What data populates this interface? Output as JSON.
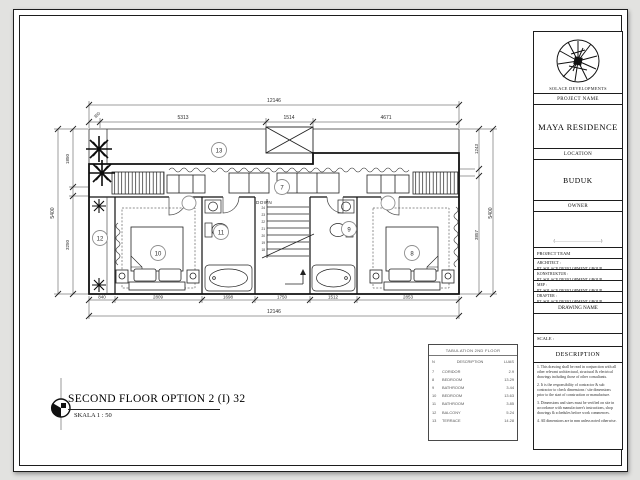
{
  "sheet_title": {
    "text": "SECOND FLOOR OPTION 2  (I) 32",
    "scale": "SKALA 1 : 50"
  },
  "title_block": {
    "company": "SOLACE DEVELOPMENTS",
    "project_name_label": "PROJECT NAME",
    "project_name": "MAYA RESIDENCE",
    "location_label": "LOCATION",
    "location": "BUDUK",
    "owner_label": "OWNER",
    "owner_value": "(..............................................)",
    "project_team_label": "PROJECT TEAM",
    "team": [
      {
        "role": "ARCHITECT :",
        "name": "PT. SOLACE DEVELOPMENT GROUP"
      },
      {
        "role": "KONSTRUKTUR :",
        "name": "PT. SOLACE DEVELOPMENT GROUP"
      },
      {
        "role": "MEP :",
        "name": "PT. SOLACE DEVELOPMENT GROUP"
      },
      {
        "role": "DRAFTER :",
        "name": "PT. SOLACE DEVELOPMENT GROUP"
      }
    ],
    "drawing_name_label": "DRAWING NAME",
    "scale_label": "SCALE :",
    "description_label": "DESCRIPTION",
    "notes": [
      "1. This drawing shall be read in conjunction with all other relevant architectural, structural & electrical drawings including those of other consultants.",
      "2. It is the responsibility of contractor & sub contractor to check dimensions / site dimensions prior to the start of construction or manufacture.",
      "3. Dimensions and sizes must be verified on site in accordance with manufacturer's instructions, shop drawings & schedules before work commences.",
      "4. All dimensions are in mm unless noted otherwise."
    ]
  },
  "plan": {
    "down_label": "DOWN",
    "stair_risers": [
      "24",
      "23",
      "22",
      "21",
      "20",
      "19",
      "18"
    ],
    "tags": {
      "terrace": "13",
      "corridor": "7",
      "balcony": "12",
      "bedroom_left": "10",
      "bathroom_left": "11",
      "bathroom_right": "9",
      "bedroom_right": "8"
    },
    "dims": {
      "top_overall": "12146",
      "top_segments": [
        "350",
        "5313",
        "1514",
        "4671"
      ],
      "bottom_segments": [
        "840",
        "2809",
        "1698",
        "1750",
        "1512",
        "2853"
      ],
      "bottom_overall": "12146",
      "left_overall": "5400",
      "left_segments": [
        "1850",
        "3250"
      ],
      "right_segments": [
        "1243",
        "3857"
      ],
      "right_overall": "5400"
    }
  },
  "legend": {
    "title": "TABULATION 2ND FLOOR",
    "columns": [
      "N",
      "DESCRIPTION",
      "LUAS"
    ],
    "rows": [
      {
        "n": "7",
        "desc": "CORIDOR",
        "area": "2.9"
      },
      {
        "n": "8",
        "desc": "BEDROOM",
        "area": "13.29"
      },
      {
        "n": "9",
        "desc": "BATHROOM",
        "area": "3.44"
      },
      {
        "n": "10",
        "desc": "BEDROOM",
        "area": "13.63"
      },
      {
        "n": "11",
        "desc": "BATHROOM",
        "area": "3.85"
      },
      {
        "n": "12",
        "desc": "BALCONY",
        "area": "5.24"
      },
      {
        "n": "13",
        "desc": "TERRACE",
        "area": "14.28"
      }
    ]
  }
}
